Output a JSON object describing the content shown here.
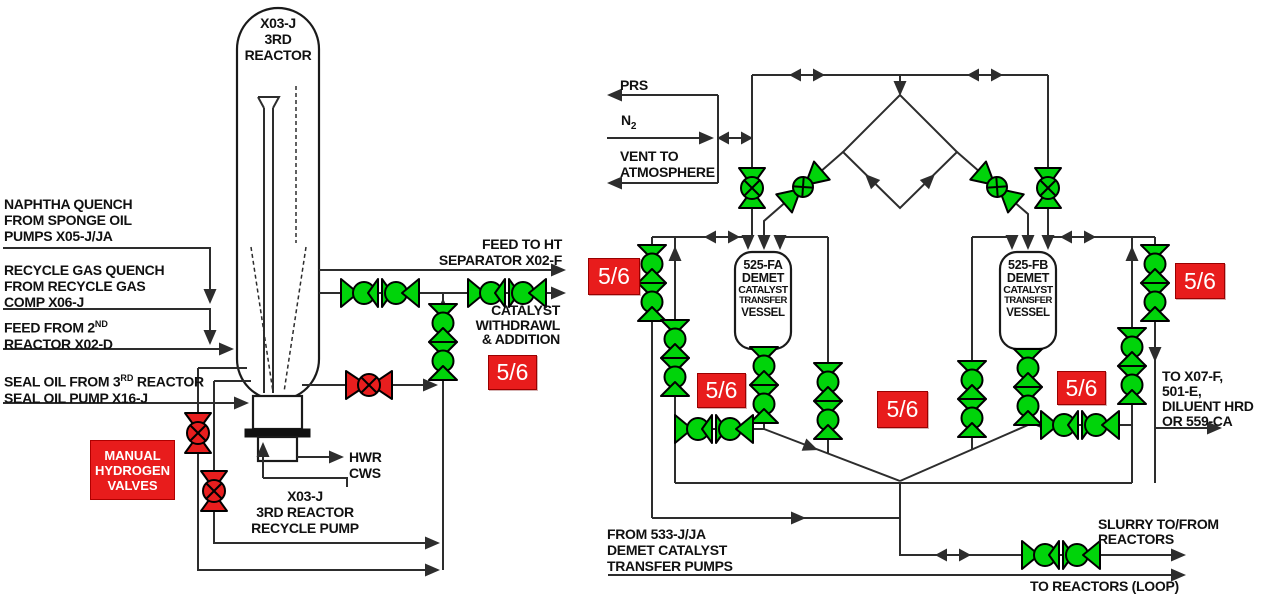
{
  "colors": {
    "open_valve_green": "#00d40a",
    "closed_valve_red": "#e81e1e",
    "note_badge_red": "#e81c1c",
    "line": "#2d2d2d"
  },
  "left_diagram": {
    "reactor_title": "X03-J\n3RD\nREACTOR",
    "label_naphtha": "NAPHTHA QUENCH\nFROM SPONGE OIL\nPUMPS X05-J/JA",
    "label_recycle_gas": "RECYCLE GAS QUENCH\nFROM RECYCLE GAS\nCOMP X06-J",
    "label_feed_pre": "FEED FROM 2",
    "label_feed_sup": "ND",
    "label_feed_line2": "REACTOR X02-D",
    "label_sealoil_pre": "SEAL OIL FROM 3",
    "label_sealoil_sup": "RD",
    "label_sealoil_post": " REACTOR",
    "label_sealoil_line2": "SEAL OIL PUMP X16-J",
    "manual_valves_box": "MANUAL\nHYDROGEN\nVALVES",
    "label_feed_ht": "FEED TO HT\nSEPARATOR X02-F",
    "label_catalyst": "CATALYST\nWITHDRAWL\n& ADDITION",
    "badge": "5/6",
    "label_hwr": "HWR",
    "label_cws": "CWS",
    "pump_label": "X03-J\n3RD REACTOR\nRECYCLE PUMP"
  },
  "right_diagram": {
    "label_prs": "PRS",
    "label_n2_base": "N",
    "label_n2_sub": "2",
    "label_vent": "VENT TO\nATMOSPHERE",
    "vessel_a": {
      "id": "525-FA",
      "l2": "DEMET",
      "l3": "CATALYST",
      "l4": "TRANSFER",
      "l5": "VESSEL"
    },
    "vessel_b": {
      "id": "525-FB",
      "l2": "DEMET",
      "l3": "CATALYST",
      "l4": "TRANSFER",
      "l5": "VESSEL"
    },
    "badge": "5/6",
    "label_to_x07": "TO X07-F,\n501-E,\nDILUENT HRD\nOR 559-CA",
    "label_from_533": "FROM 533-J/JA\nDEMET CATALYST\nTRANSFER PUMPS",
    "label_slurry": "SLURRY TO/FROM\nREACTORS",
    "label_to_reactors_loop": "TO REACTORS (LOOP)"
  }
}
